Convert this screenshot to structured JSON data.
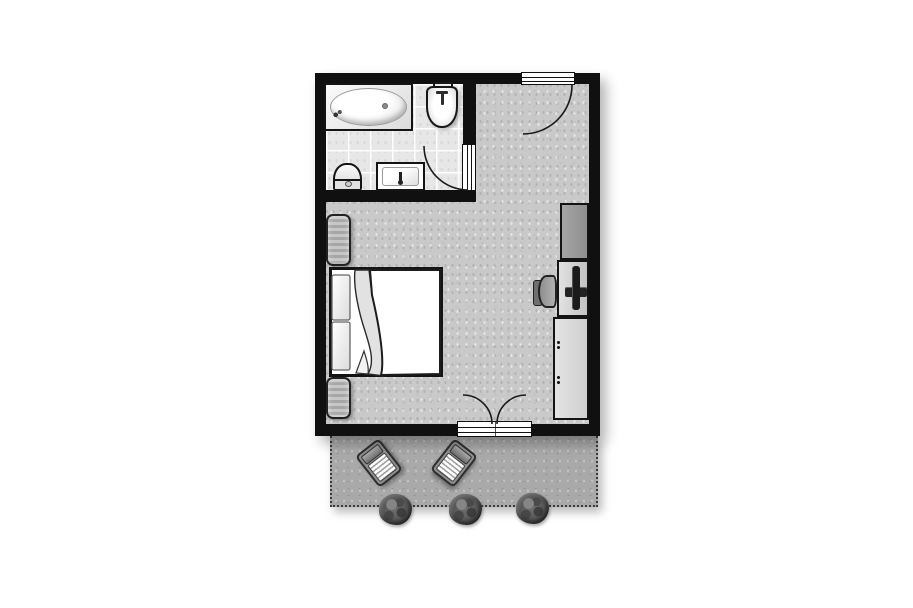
{
  "plan": {
    "kind": "apartment-floor-plan",
    "style": "top-down architectural drawing, black walls on white background",
    "rooms": [
      {
        "name": "bathroom",
        "position": "top-left",
        "floor": "light gray tiles",
        "fixtures": [
          "bathtub",
          "washbasin",
          "toilet",
          "vanity-sink"
        ],
        "doors": [
          "single swing door opening into bathroom"
        ]
      },
      {
        "name": "main-room",
        "position": "center",
        "floor": "speckled gray",
        "fixtures": [
          "double-bed",
          "pillow-upper",
          "pillow-lower",
          "nightstand-upper",
          "nightstand-lower",
          "wardrobe",
          "desk",
          "tv",
          "desk-chair",
          "sideboard-cabinet"
        ],
        "doors": [
          "entrance door top-right",
          "double french doors to terrace at bottom"
        ]
      },
      {
        "name": "terrace",
        "position": "bottom",
        "floor": "gray paving with dotted boundary",
        "fixtures": [
          "sun-lounger-left",
          "sun-lounger-right",
          "shrub-1",
          "shrub-2",
          "shrub-3"
        ]
      }
    ],
    "colors": {
      "background": "#ffffff",
      "wall": "#101010",
      "main_floor": "#c9c9c9",
      "bathroom_floor": "#e7e7e7",
      "terrace_floor": "#a9a9a9",
      "wardrobe": "#9b9b9b",
      "desk": "#cfcfcf",
      "cabinet": "#dcdcdc",
      "nightstand": "#b4b4b4",
      "bedding": "#ffffff",
      "shrub": "#4e4e4e",
      "door_arc": "#1a1a1a"
    },
    "aria": {
      "plan": "Apartment floor plan",
      "bathroom": "Bathroom",
      "main_room": "Bedroom and living area",
      "terrace": "Terrace",
      "bathtub": "Bathtub",
      "washbasin": "Washbasin",
      "toilet": "Toilet",
      "vanity": "Vanity sink",
      "bathroom_door": "Bathroom door",
      "entry_door": "Entrance door",
      "french_doors": "Double doors to terrace",
      "bed": "Double bed",
      "nightstand_upper": "Nightstand",
      "nightstand_lower": "Nightstand",
      "wardrobe": "Wardrobe",
      "desk": "Desk",
      "tv": "Television",
      "desk_chair": "Desk chair",
      "cabinet": "Sideboard cabinet",
      "lounger_left": "Sun lounger",
      "lounger_right": "Sun lounger",
      "shrub_1": "Shrub",
      "shrub_2": "Shrub",
      "shrub_3": "Shrub"
    }
  }
}
